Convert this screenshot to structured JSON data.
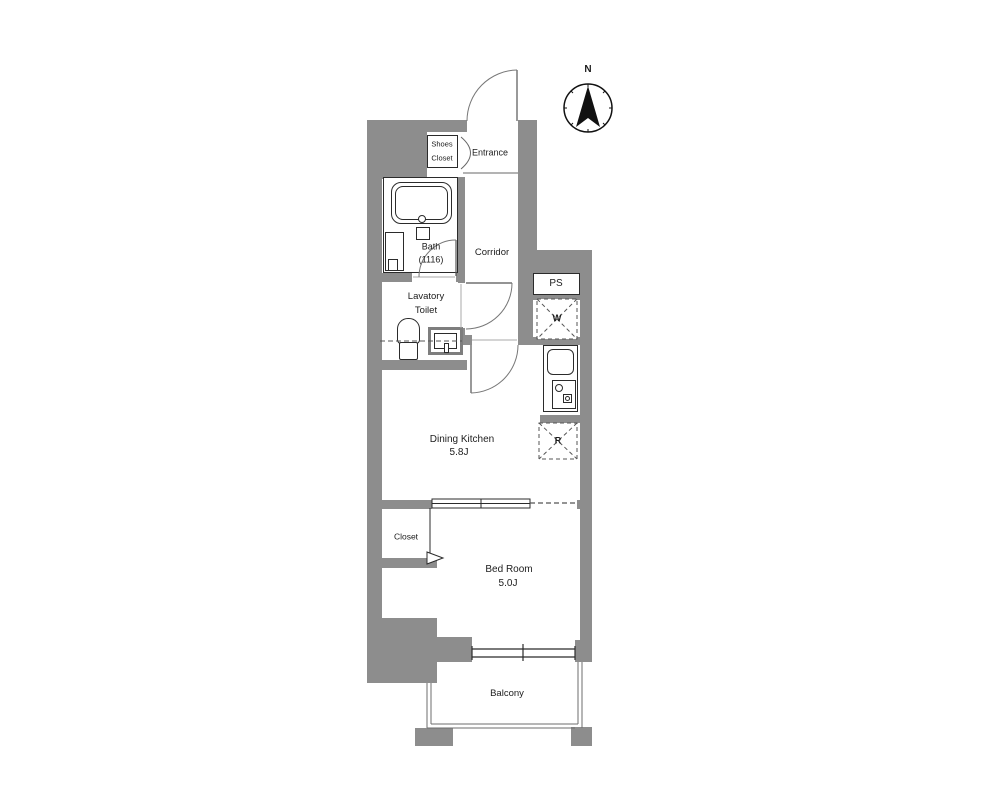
{
  "plan": {
    "compass": {
      "north_label": "N"
    },
    "labels": {
      "shoes_closet_line1": "Shoes",
      "shoes_closet_line2": "Closet",
      "entrance": "Entrance",
      "bath": "Bath",
      "bath_size": "(1116)",
      "corridor": "Corridor",
      "lavatory_line1": "Lavatory",
      "lavatory_line2": "Toilet",
      "pipe_space": "PS",
      "washer": "W",
      "dining_kitchen": "Dining Kitchen",
      "dining_kitchen_size": "5.8J",
      "fridge": "R",
      "closet": "Closet",
      "bedroom": "Bed Room",
      "bedroom_size": "5.0J",
      "balcony": "Balcony"
    },
    "colors": {
      "wall": "#8d8d8d",
      "line": "#2b2b2b",
      "background": "#ffffff"
    }
  }
}
